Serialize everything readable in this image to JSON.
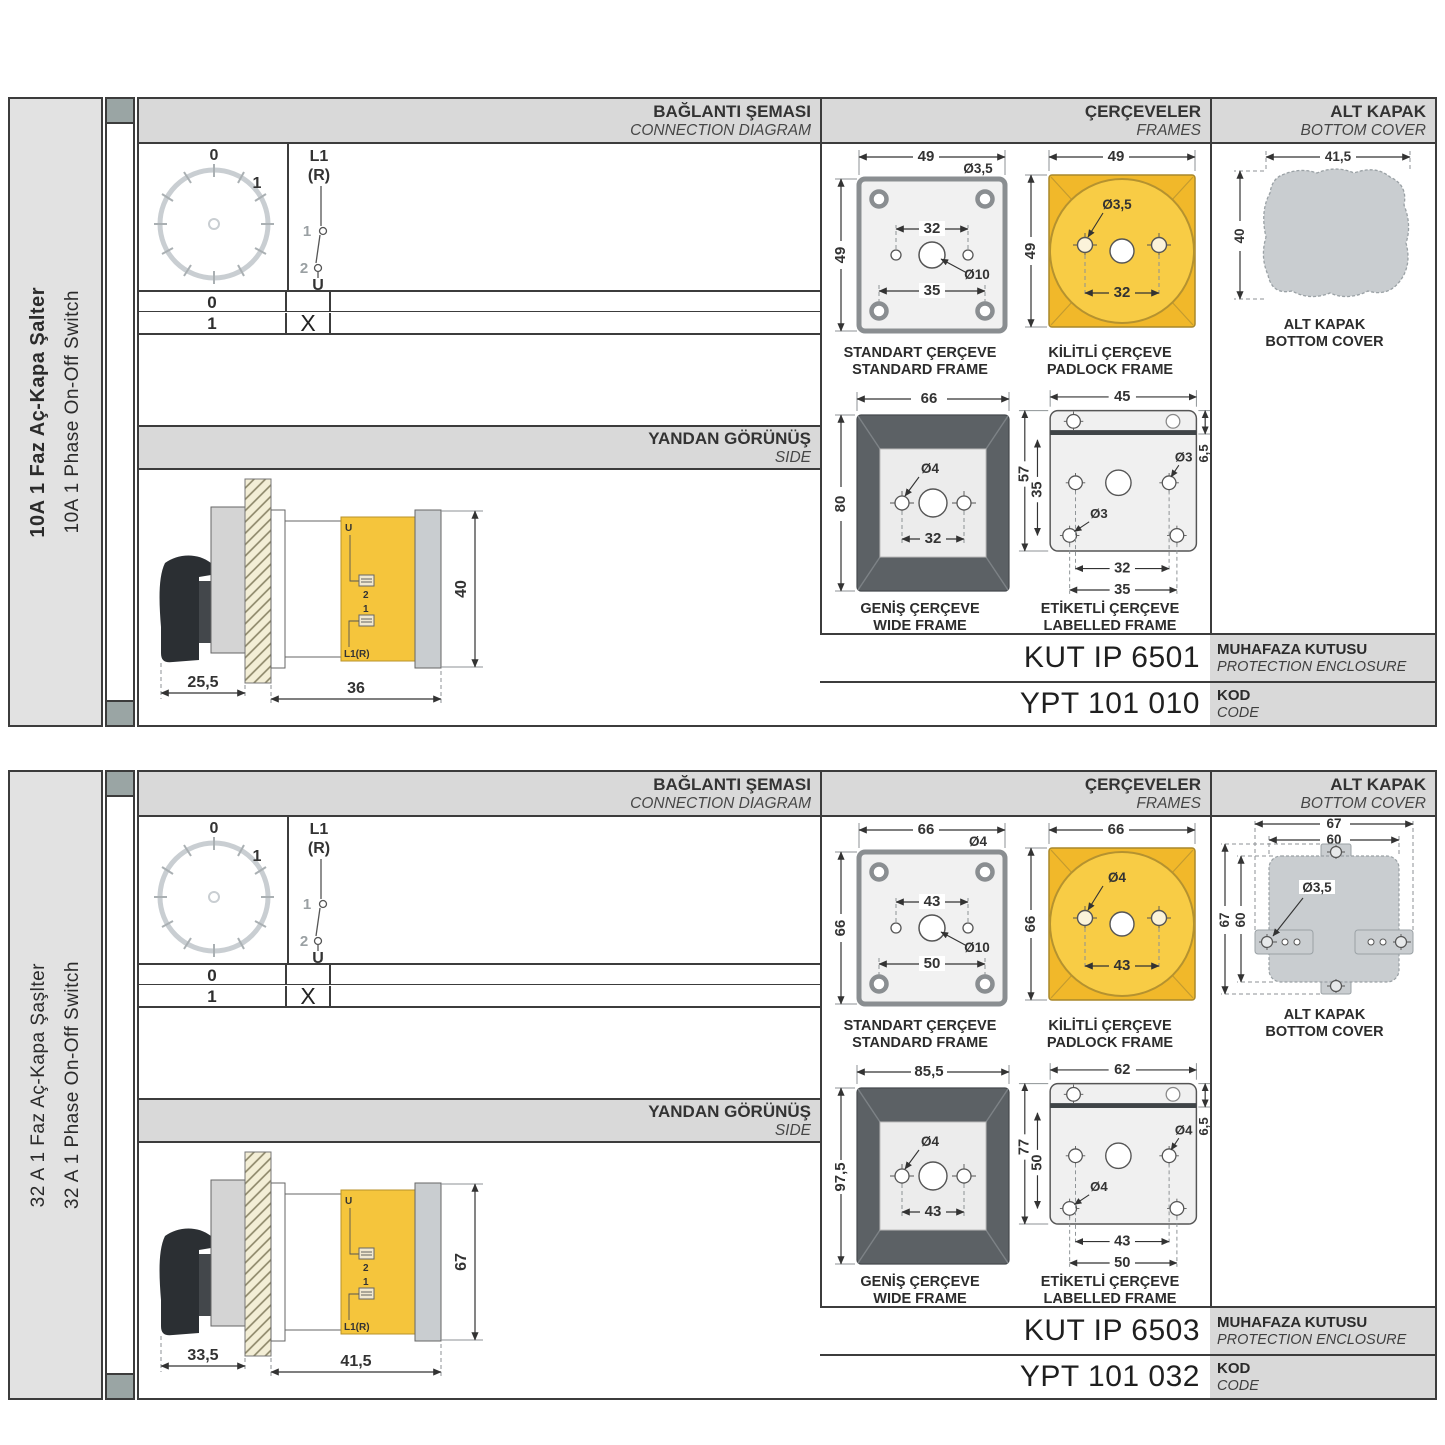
{
  "colors": {
    "accent_yellow": "#F5C53C",
    "wide_frame_gray": "#5C6165",
    "cover_gray": "#C9CDD0",
    "header_bg": "#D9D9D9",
    "sidebar_bg": "#E2E2E2",
    "cap_square": "#9AA5A4"
  },
  "sections": [
    {
      "sidebar": {
        "title_tr": "10A 1 Faz Aç-Kapa Şalter",
        "title_en": "10A 1 Phase On-Off Switch"
      },
      "headers": {
        "connection_tr": "BAĞLANTI ŞEMASI",
        "connection_en": "CONNECTION DIAGRAM",
        "frames_tr": "ÇERÇEVELER",
        "frames_en": "FRAMES",
        "cover_tr": "ALT KAPAK",
        "cover_en": "BOTTOM COVER",
        "side_tr": "YANDAN GÖRÜNÜŞ",
        "side_en": "SIDE"
      },
      "diagram": {
        "dial_0": "0",
        "dial_1": "1",
        "sw_l1": "L1",
        "sw_r": "(R)",
        "sw_1": "1",
        "sw_2": "2",
        "sw_u": "U",
        "row0": "0",
        "row1": "1",
        "mark": "X"
      },
      "side": {
        "dim_a": "25,5",
        "dim_b": "36",
        "dim_h": "40",
        "u": "U",
        "t2": "2",
        "t1": "1",
        "l1r": "L1(R)"
      },
      "frames": {
        "standard": {
          "tr": "STANDART ÇERÇEVE",
          "en": "STANDARD FRAME",
          "w": "49",
          "h": "49",
          "hole": "Ø3,5",
          "inner": "32",
          "center": "Ø10",
          "lower": "35"
        },
        "padlock": {
          "tr": "KİLİTLİ ÇERÇEVE",
          "en": "PADLOCK FRAME",
          "w": "49",
          "h": "49",
          "hole": "Ø3,5",
          "inner": "32"
        },
        "wide": {
          "tr": "GENİŞ ÇERÇEVE",
          "en": "WIDE FRAME",
          "w": "66",
          "h": "80",
          "hole": "Ø4",
          "inner": "32"
        },
        "labelled": {
          "tr": "ETİKETLİ ÇERÇEVE",
          "en": "LABELLED FRAME",
          "w": "45",
          "strip": "6,5",
          "h": "57",
          "inner_h": "35",
          "hole_r": "Ø3",
          "hole_l": "Ø3",
          "inner": "32",
          "lower": "35"
        }
      },
      "cover": {
        "tr": "ALT KAPAK",
        "en": "BOTTOM COVER",
        "w": "41,5",
        "h": "40"
      },
      "codes": {
        "enclosure": "KUT IP 6501",
        "enclosure_tr": "MUHAFAZA KUTUSU",
        "enclosure_en": "PROTECTION ENCLOSURE",
        "code": "YPT 101 010",
        "code_tr": "KOD",
        "code_en": "CODE"
      }
    },
    {
      "sidebar": {
        "title_tr": "32 A 1 Faz Aç-Kapa Şaşlter",
        "title_en": "32 A 1 Phase On-Off Switch"
      },
      "headers": {
        "connection_tr": "BAĞLANTI ŞEMASI",
        "connection_en": "CONNECTION DIAGRAM",
        "frames_tr": "ÇERÇEVELER",
        "frames_en": "FRAMES",
        "cover_tr": "ALT KAPAK",
        "cover_en": "BOTTOM COVER",
        "side_tr": "YANDAN GÖRÜNÜŞ",
        "side_en": "SIDE"
      },
      "diagram": {
        "dial_0": "0",
        "dial_1": "1",
        "sw_l1": "L1",
        "sw_r": "(R)",
        "sw_1": "1",
        "sw_2": "2",
        "sw_u": "U",
        "row0": "0",
        "row1": "1",
        "mark": "X"
      },
      "side": {
        "dim_a": "33,5",
        "dim_b": "41,5",
        "dim_h": "67",
        "u": "U",
        "t2": "2",
        "t1": "1",
        "l1r": "L1(R)"
      },
      "frames": {
        "standard": {
          "tr": "STANDART ÇERÇEVE",
          "en": "STANDARD FRAME",
          "w": "66",
          "h": "66",
          "hole": "Ø4",
          "inner": "43",
          "center": "Ø10",
          "lower": "50"
        },
        "padlock": {
          "tr": "KİLİTLİ ÇERÇEVE",
          "en": "PADLOCK FRAME",
          "w": "66",
          "h": "66",
          "hole": "Ø4",
          "inner": "43"
        },
        "wide": {
          "tr": "GENİŞ ÇERÇEVE",
          "en": "WIDE FRAME",
          "w": "85,5",
          "h": "97,5",
          "hole": "Ø4",
          "inner": "43"
        },
        "labelled": {
          "tr": "ETİKETLİ ÇERÇEVE",
          "en": "LABELLED FRAME",
          "w": "62",
          "strip": "6,5",
          "h": "77",
          "inner_h": "50",
          "hole_r": "Ø4",
          "hole_l": "Ø4",
          "inner": "43",
          "lower": "50"
        }
      },
      "cover": {
        "tr": "ALT KAPAK",
        "en": "BOTTOM COVER",
        "w_outer": "67",
        "w_inner": "60",
        "h_outer": "67",
        "h_inner": "60",
        "hole": "Ø3,5"
      },
      "codes": {
        "enclosure": "KUT IP 6503",
        "enclosure_tr": "MUHAFAZA KUTUSU",
        "enclosure_en": "PROTECTION ENCLOSURE",
        "code": "YPT 101 032",
        "code_tr": "KOD",
        "code_en": "CODE"
      }
    }
  ]
}
